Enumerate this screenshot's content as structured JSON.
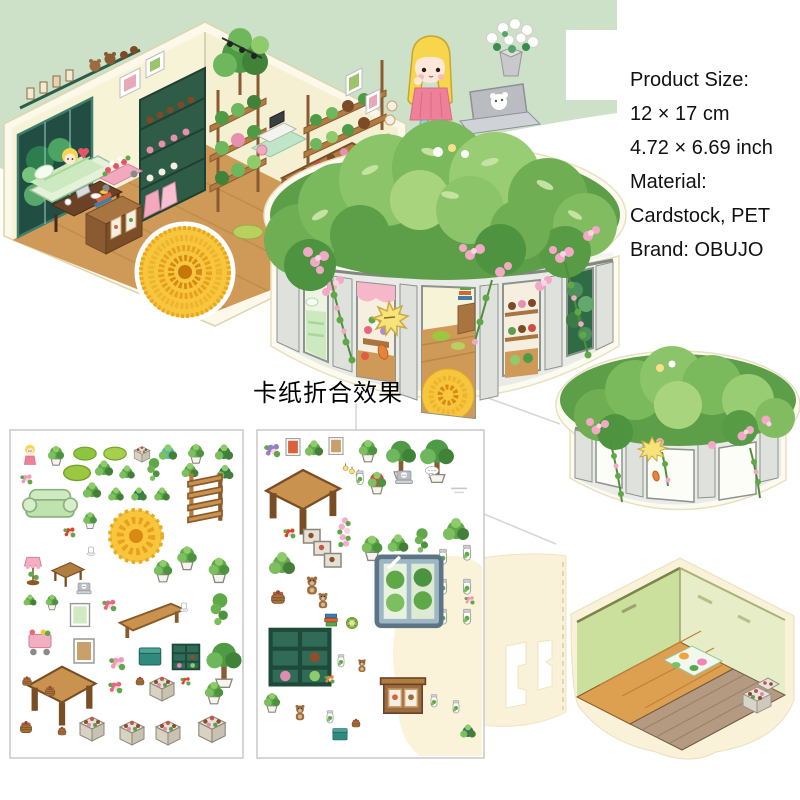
{
  "page": {
    "width": 800,
    "height": 800,
    "background": "#ffffff"
  },
  "colors": {
    "panel_green": "#cde1c9",
    "cardstock_cream": "#f9f2d9",
    "sheet_border": "#c9c9c9",
    "wall_cream": "#f7f3d7",
    "wood_floor": "#cf9a58",
    "cylinder_wall": "#e9ebe6",
    "foliage_green": "#6fae52",
    "flower_pink": "#f2a9c6",
    "mum_yellow": "#f6c63e",
    "text": "#111111"
  },
  "product_info": {
    "lines": [
      "Product Size:",
      "12 × 17 cm",
      "4.72 × 6.69 inch",
      "Material:",
      "Cardstock, PET",
      "Brand: OBUJO"
    ]
  },
  "caption": {
    "folded_effect_label": "卡纸折合效果"
  },
  "sections": {
    "room_scene": "flower-room-isometric-illustration",
    "girl": "girl-with-laptop-illustration",
    "bouquet": "tulip-bouquet-icon",
    "big_cylinder": "folded-cylinder-room-illustration",
    "small_cylinder": "cylinder-exterior-illustration",
    "cutout": "cardstock-cutout-piece",
    "empty_room": "empty-room-illustration",
    "sheet_left": "sticker-sheet-left",
    "sheet_right": "sticker-sheet-right"
  },
  "sticker_sheets": [
    {
      "name": "sticker-sheet-left",
      "items": [
        {
          "t": "girl",
          "x": 30,
          "y": 456,
          "s": 0.7
        },
        {
          "t": "plant",
          "x": 56,
          "y": 454,
          "s": 0.7
        },
        {
          "t": "rug",
          "x": 85,
          "y": 452,
          "s": 0.8
        },
        {
          "t": "rug",
          "x": 115,
          "y": 452,
          "s": 0.8,
          "c": "#a8cf4c"
        },
        {
          "t": "crate",
          "x": 142,
          "y": 453,
          "s": 0.65
        },
        {
          "t": "bush",
          "x": 168,
          "y": 452,
          "s": 0.7,
          "c": "#57b8a8"
        },
        {
          "t": "plant",
          "x": 196,
          "y": 452,
          "s": 0.7
        },
        {
          "t": "bush",
          "x": 224,
          "y": 452,
          "s": 0.7,
          "c": "#3f8238"
        },
        {
          "t": "flower",
          "x": 27,
          "y": 479,
          "s": 0.6
        },
        {
          "t": "rug",
          "x": 77,
          "y": 471,
          "s": 0.95,
          "c": "#9cc840"
        },
        {
          "t": "bush",
          "x": 104,
          "y": 468,
          "s": 0.7
        },
        {
          "t": "bush",
          "x": 127,
          "y": 472,
          "s": 0.6
        },
        {
          "t": "hang",
          "x": 154,
          "y": 470,
          "s": 0.75
        },
        {
          "t": "bush",
          "x": 190,
          "y": 470,
          "s": 0.65
        },
        {
          "t": "bush",
          "x": 225,
          "y": 472,
          "s": 0.65,
          "c": "#2f7d4f"
        },
        {
          "t": "shelf",
          "x": 205,
          "y": 497,
          "s": 1.7
        },
        {
          "t": "sofa",
          "x": 50,
          "y": 505,
          "s": 1.7
        },
        {
          "t": "bush",
          "x": 92,
          "y": 490,
          "s": 0.7
        },
        {
          "t": "bush",
          "x": 116,
          "y": 494,
          "s": 0.6
        },
        {
          "t": "bush",
          "x": 139,
          "y": 494,
          "s": 0.6,
          "c": "#2f7d4f"
        },
        {
          "t": "bush",
          "x": 162,
          "y": 494,
          "s": 0.6
        },
        {
          "t": "plant",
          "x": 90,
          "y": 519,
          "s": 0.6
        },
        {
          "t": "mum",
          "x": 136,
          "y": 536,
          "s": 1.75
        },
        {
          "t": "flower",
          "x": 70,
          "y": 532,
          "s": 0.6,
          "c": "#d8452f"
        },
        {
          "t": "cup",
          "x": 91,
          "y": 549,
          "s": 0.5
        },
        {
          "t": "lamp",
          "x": 33,
          "y": 570,
          "s": 1.05
        },
        {
          "t": "table",
          "x": 68,
          "y": 573,
          "s": 1.15
        },
        {
          "t": "plant",
          "x": 187,
          "y": 556,
          "s": 0.85
        },
        {
          "t": "plant",
          "x": 163,
          "y": 569,
          "s": 0.8
        },
        {
          "t": "plant",
          "x": 219,
          "y": 568,
          "s": 0.9
        },
        {
          "t": "bush",
          "x": 30,
          "y": 600,
          "s": 0.5
        },
        {
          "t": "plant",
          "x": 52,
          "y": 601,
          "s": 0.55
        },
        {
          "t": "laptop",
          "x": 84,
          "y": 589,
          "s": 0.6
        },
        {
          "t": "frame",
          "x": 80,
          "y": 615,
          "s": 0.95,
          "c": "#cfe9c0"
        },
        {
          "t": "flower",
          "x": 110,
          "y": 605,
          "s": 0.7,
          "c": "#e8677d"
        },
        {
          "t": "bench",
          "x": 152,
          "y": 619,
          "s": 1.9
        },
        {
          "t": "cup",
          "x": 184,
          "y": 605,
          "s": 0.5
        },
        {
          "t": "hang",
          "x": 220,
          "y": 610,
          "s": 1.05
        },
        {
          "t": "cart",
          "x": 40,
          "y": 641,
          "s": 1.1
        },
        {
          "t": "frame",
          "x": 84,
          "y": 651,
          "s": 1.0,
          "c": "#caa06a"
        },
        {
          "t": "flower",
          "x": 118,
          "y": 663,
          "s": 0.8
        },
        {
          "t": "box",
          "x": 150,
          "y": 656,
          "s": 0.9
        },
        {
          "t": "cabinet",
          "x": 186,
          "y": 656,
          "s": 0.95
        },
        {
          "t": "tree",
          "x": 224,
          "y": 663,
          "s": 1.35
        },
        {
          "t": "bigtable",
          "x": 62,
          "y": 694,
          "s": 2.1
        },
        {
          "t": "basket",
          "x": 27,
          "y": 681,
          "s": 0.55
        },
        {
          "t": "basket",
          "x": 50,
          "y": 691,
          "s": 0.6
        },
        {
          "t": "flower",
          "x": 116,
          "y": 687,
          "s": 0.7,
          "c": "#e8677d"
        },
        {
          "t": "basket",
          "x": 140,
          "y": 681,
          "s": 0.5
        },
        {
          "t": "crate",
          "x": 162,
          "y": 687,
          "s": 1.0
        },
        {
          "t": "flower",
          "x": 186,
          "y": 681,
          "s": 0.5,
          "c": "#d8452f"
        },
        {
          "t": "plant",
          "x": 214,
          "y": 691,
          "s": 0.8
        },
        {
          "t": "basket",
          "x": 26,
          "y": 727,
          "s": 0.7
        },
        {
          "t": "basket",
          "x": 62,
          "y": 731,
          "s": 0.5
        },
        {
          "t": "crate",
          "x": 92,
          "y": 727,
          "s": 1.0
        },
        {
          "t": "crate",
          "x": 132,
          "y": 731,
          "s": 1.0
        },
        {
          "t": "crate",
          "x": 168,
          "y": 731,
          "s": 1.0
        },
        {
          "t": "crate",
          "x": 212,
          "y": 727,
          "s": 1.1
        }
      ]
    },
    {
      "name": "sticker-sheet-right",
      "items": [
        {
          "t": "flower",
          "x": 273,
          "y": 450,
          "s": 0.8,
          "c": "#9a7ec9"
        },
        {
          "t": "frame",
          "x": 293,
          "y": 447,
          "s": 0.7,
          "c": "#d8623a"
        },
        {
          "t": "bush",
          "x": 314,
          "y": 448,
          "s": 0.7
        },
        {
          "t": "frame",
          "x": 336,
          "y": 446,
          "s": 0.7,
          "c": "#caa06a"
        },
        {
          "t": "plant",
          "x": 368,
          "y": 449,
          "s": 0.8
        },
        {
          "t": "tree",
          "x": 401,
          "y": 458,
          "s": 1.15
        },
        {
          "t": "tree",
          "x": 437,
          "y": 459,
          "s": 1.3
        },
        {
          "t": "bigtable",
          "x": 303,
          "y": 500,
          "s": 2.3
        },
        {
          "t": "lights",
          "x": 352,
          "y": 473,
          "s": 0.8
        },
        {
          "t": "plant",
          "x": 377,
          "y": 481,
          "s": 0.8,
          "c": "#c94f43"
        },
        {
          "t": "laptop",
          "x": 404,
          "y": 478,
          "s": 0.7
        },
        {
          "t": "bubble",
          "x": 432,
          "y": 473,
          "s": 0.6
        },
        {
          "t": "logo",
          "x": 459,
          "y": 490,
          "s": 0.8
        },
        {
          "t": "jar",
          "x": 360,
          "y": 478,
          "s": 0.55
        },
        {
          "t": "flower",
          "x": 290,
          "y": 533,
          "s": 0.6,
          "c": "#d8452f"
        },
        {
          "t": "steps",
          "x": 323,
          "y": 549,
          "s": 1.5
        },
        {
          "t": "vine",
          "x": 345,
          "y": 533,
          "s": 1.05
        },
        {
          "t": "plant",
          "x": 372,
          "y": 546,
          "s": 0.9
        },
        {
          "t": "bush",
          "x": 398,
          "y": 543,
          "s": 0.8
        },
        {
          "t": "hang",
          "x": 422,
          "y": 541,
          "s": 0.8
        },
        {
          "t": "bush",
          "x": 456,
          "y": 529,
          "s": 1.0
        },
        {
          "t": "bush",
          "x": 282,
          "y": 563,
          "s": 1.0,
          "c": "#6aa84f"
        },
        {
          "t": "bear",
          "x": 312,
          "y": 586,
          "s": 0.7
        },
        {
          "t": "basket",
          "x": 278,
          "y": 597,
          "s": 0.8
        },
        {
          "t": "bear",
          "x": 323,
          "y": 601,
          "s": 0.6
        },
        {
          "t": "jar",
          "x": 443,
          "y": 557,
          "s": 0.6
        },
        {
          "t": "jar",
          "x": 467,
          "y": 553,
          "s": 0.6
        },
        {
          "t": "jar",
          "x": 443,
          "y": 587,
          "s": 0.6
        },
        {
          "t": "jar",
          "x": 467,
          "y": 587,
          "s": 0.6
        },
        {
          "t": "jar",
          "x": 443,
          "y": 617,
          "s": 0.6
        },
        {
          "t": "jar",
          "x": 467,
          "y": 617,
          "s": 0.6
        },
        {
          "t": "books",
          "x": 331,
          "y": 619,
          "s": 0.7
        },
        {
          "t": "kiwi",
          "x": 352,
          "y": 623,
          "s": 0.6
        },
        {
          "t": "fridge",
          "x": 409,
          "y": 589,
          "s": 2.3
        },
        {
          "t": "cabinet",
          "x": 300,
          "y": 655,
          "s": 2.1
        },
        {
          "t": "jar",
          "x": 341,
          "y": 661,
          "s": 0.5
        },
        {
          "t": "bear",
          "x": 362,
          "y": 666,
          "s": 0.5
        },
        {
          "t": "flower",
          "x": 330,
          "y": 679,
          "s": 0.5,
          "c": "#e8833c"
        },
        {
          "t": "drawer",
          "x": 403,
          "y": 694,
          "s": 1.6
        },
        {
          "t": "plant",
          "x": 272,
          "y": 701,
          "s": 0.7
        },
        {
          "t": "bear",
          "x": 300,
          "y": 713,
          "s": 0.6
        },
        {
          "t": "jar",
          "x": 330,
          "y": 717,
          "s": 0.5
        },
        {
          "t": "basket",
          "x": 356,
          "y": 723,
          "s": 0.5
        },
        {
          "t": "box",
          "x": 340,
          "y": 734,
          "s": 0.6
        },
        {
          "t": "jar",
          "x": 434,
          "y": 701,
          "s": 0.5
        },
        {
          "t": "jar",
          "x": 456,
          "y": 707,
          "s": 0.5
        },
        {
          "t": "bush",
          "x": 468,
          "y": 731,
          "s": 0.6,
          "c": "#3c6f5f"
        },
        {
          "t": "flower",
          "x": 470,
          "y": 600,
          "s": 0.5
        }
      ]
    }
  ]
}
